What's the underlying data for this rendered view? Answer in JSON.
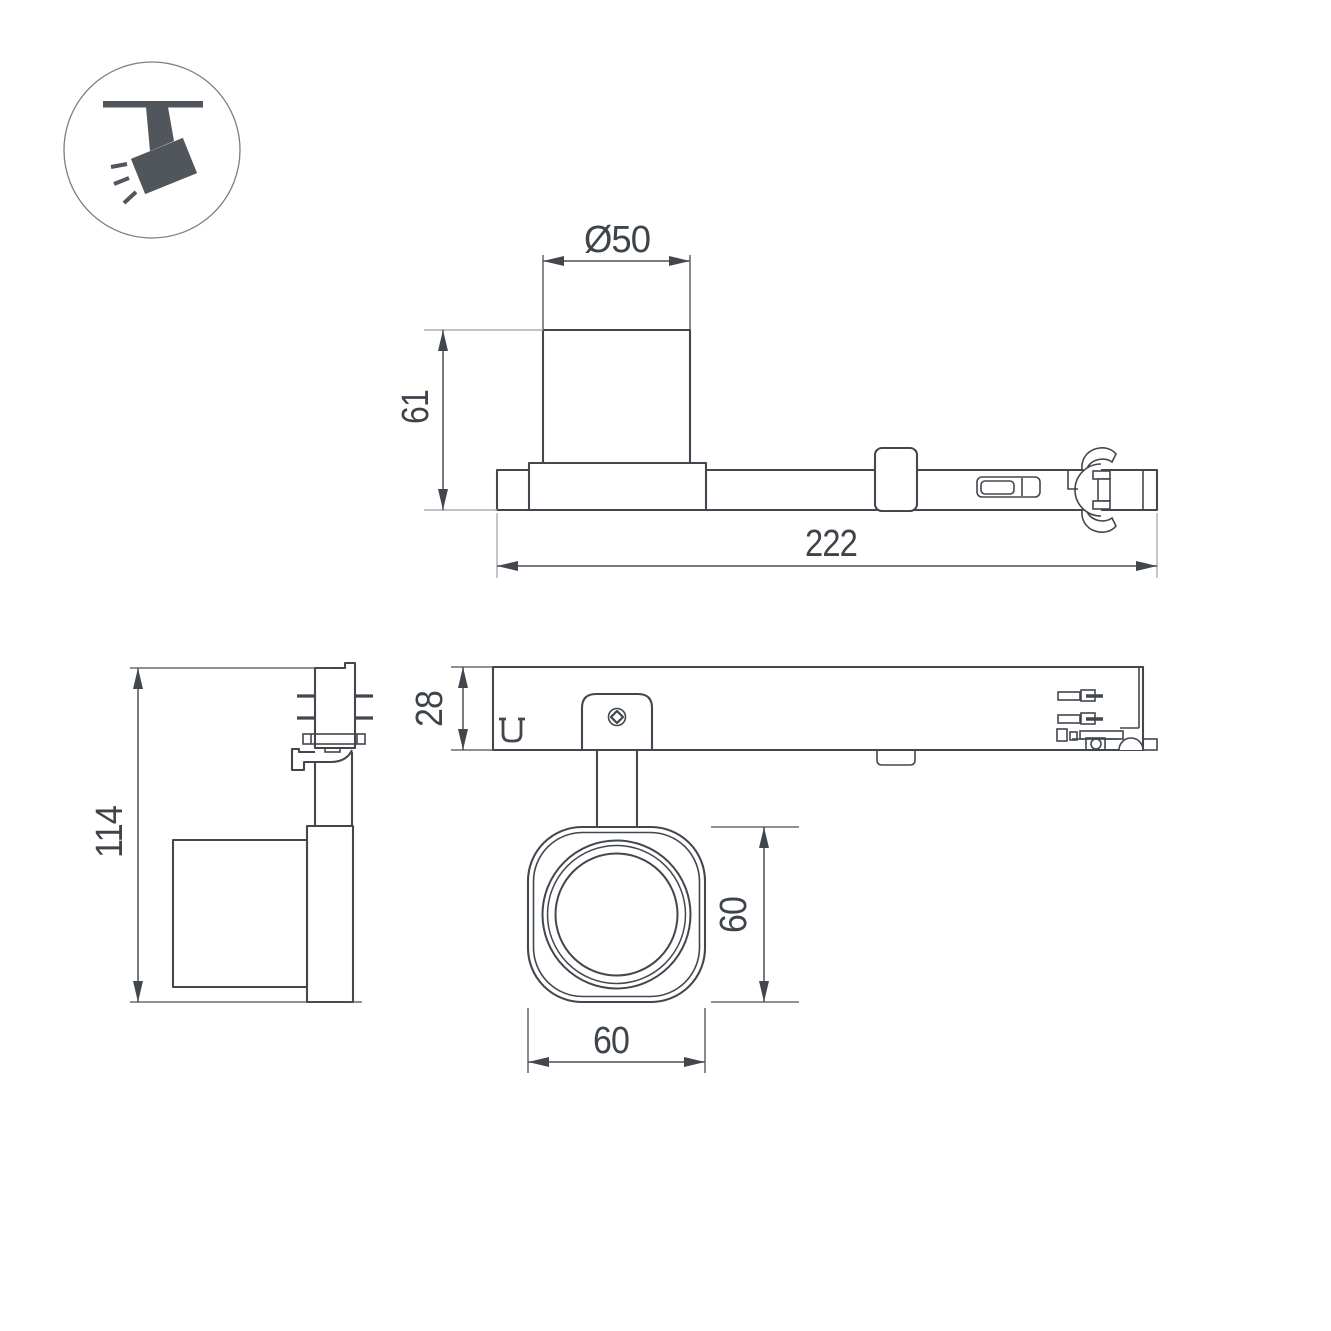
{
  "page": {
    "background": "#ffffff"
  },
  "colors": {
    "line": "#42474d",
    "light_line": "#abafb3",
    "text": "#3f444a",
    "icon_fill": "#50565c",
    "icon_ring": "#797e83"
  },
  "icon": {
    "name": "track-spotlight-icon"
  },
  "views": {
    "side": {
      "title": "side-view",
      "dims": {
        "diameter": "Ø50",
        "body_height": "61",
        "track_length": "222"
      }
    },
    "end": {
      "title": "end-view",
      "dims": {
        "total_height": "114"
      }
    },
    "plan": {
      "title": "plan-view",
      "dims": {
        "track_width": "28"
      }
    },
    "head": {
      "title": "head-front-view",
      "dims": {
        "height": "60",
        "width": "60"
      }
    }
  }
}
